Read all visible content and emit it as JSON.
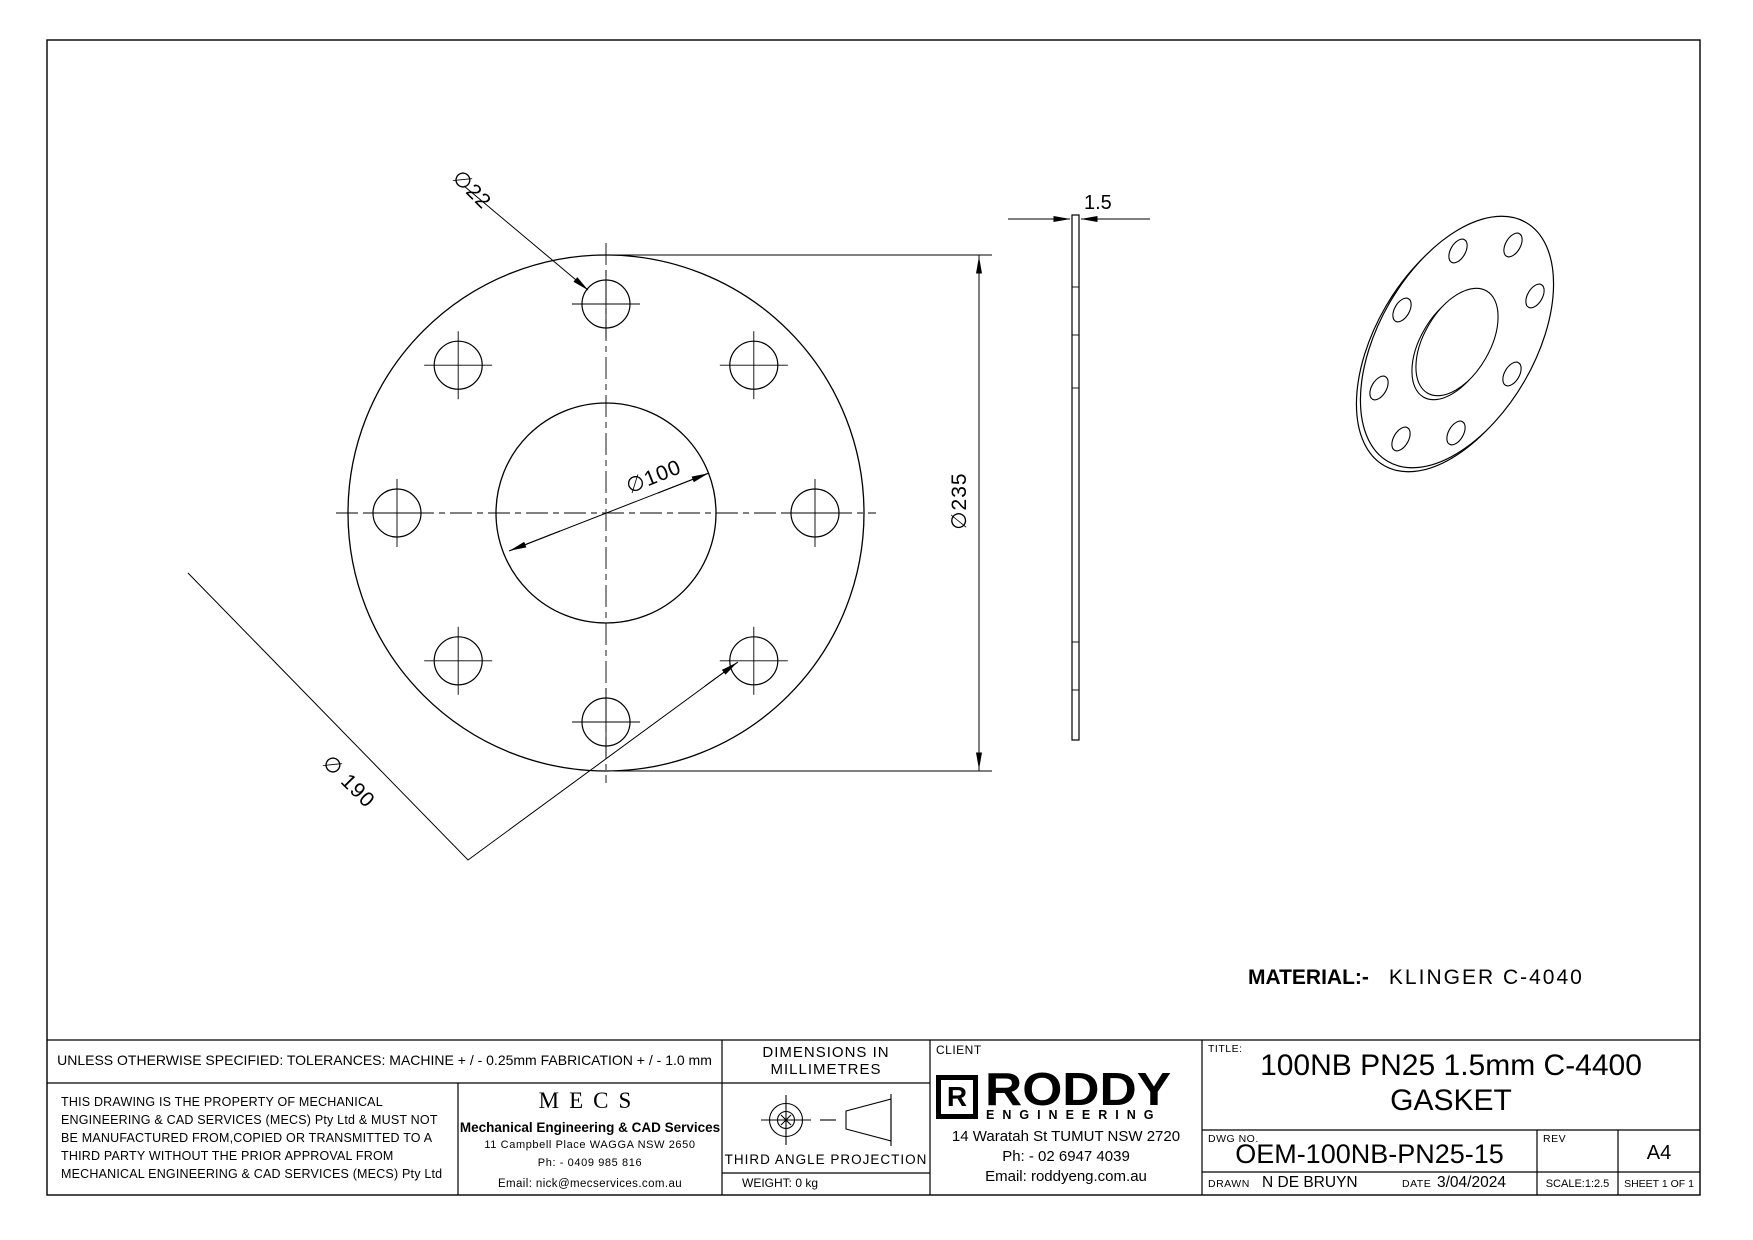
{
  "drawing": {
    "dimensions": {
      "bolt_hole_dia": "∅22",
      "bore_dia": "∅100",
      "outer_dia": "∅235",
      "bolt_circle_dia": "∅ 190",
      "thickness": "1.5"
    },
    "material": {
      "label": "MATERIAL:-",
      "value": "KLINGER  C-4040"
    }
  },
  "title_block": {
    "tolerances": "UNLESS OTHERWISE SPECIFIED: TOLERANCES: MACHINE + / - 0.25mm  FABRICATION + / - 1.0 mm",
    "legal_lines": [
      "THIS DRAWING IS THE PROPERTY OF MECHANICAL",
      "ENGINEERING & CAD SERVICES (MECS) Pty Ltd & MUST NOT",
      "BE MANUFACTURED FROM,COPIED OR TRANSMITTED TO A",
      "THIRD PARTY WITHOUT THE PRIOR APPROVAL FROM",
      "MECHANICAL ENGINEERING & CAD SERVICES (MECS) Pty Ltd"
    ],
    "mecs": {
      "logo": "MECS",
      "name": "Mechanical Engineering & CAD Services",
      "address": "11 Campbell Place WAGGA NSW 2650",
      "phone": "Ph: - 0409 985 816",
      "email": "Email: nick@mecservices.com.au"
    },
    "dims_line1": "DIMENSIONS IN",
    "dims_line2": "MILLIMETRES",
    "projection": "THIRD ANGLE PROJECTION",
    "weight": "WEIGHT: 0 kg",
    "client": {
      "label": "CLIENT",
      "logo_r": "R",
      "logo_name": "RODDY",
      "logo_sub": "ENGINEERING",
      "address": "14 Waratah St TUMUT NSW 2720",
      "phone": "Ph: - 02 6947 4039",
      "email": "Email: roddyeng.com.au"
    },
    "title_label": "TITLE:",
    "title_line1": "100NB PN25 1.5mm C-4400",
    "title_line2": "GASKET",
    "dwg_label": "DWG NO.",
    "dwg_no": "OEM-100NB-PN25-15",
    "rev_label": "REV",
    "paper_size": "A4",
    "drawn_label": "DRAWN",
    "drawn_by": "N DE BRUYN",
    "date_label": "DATE",
    "date_value": "3/04/2024",
    "scale": "SCALE:1:2.5",
    "sheet": "SHEET 1 OF 1"
  }
}
